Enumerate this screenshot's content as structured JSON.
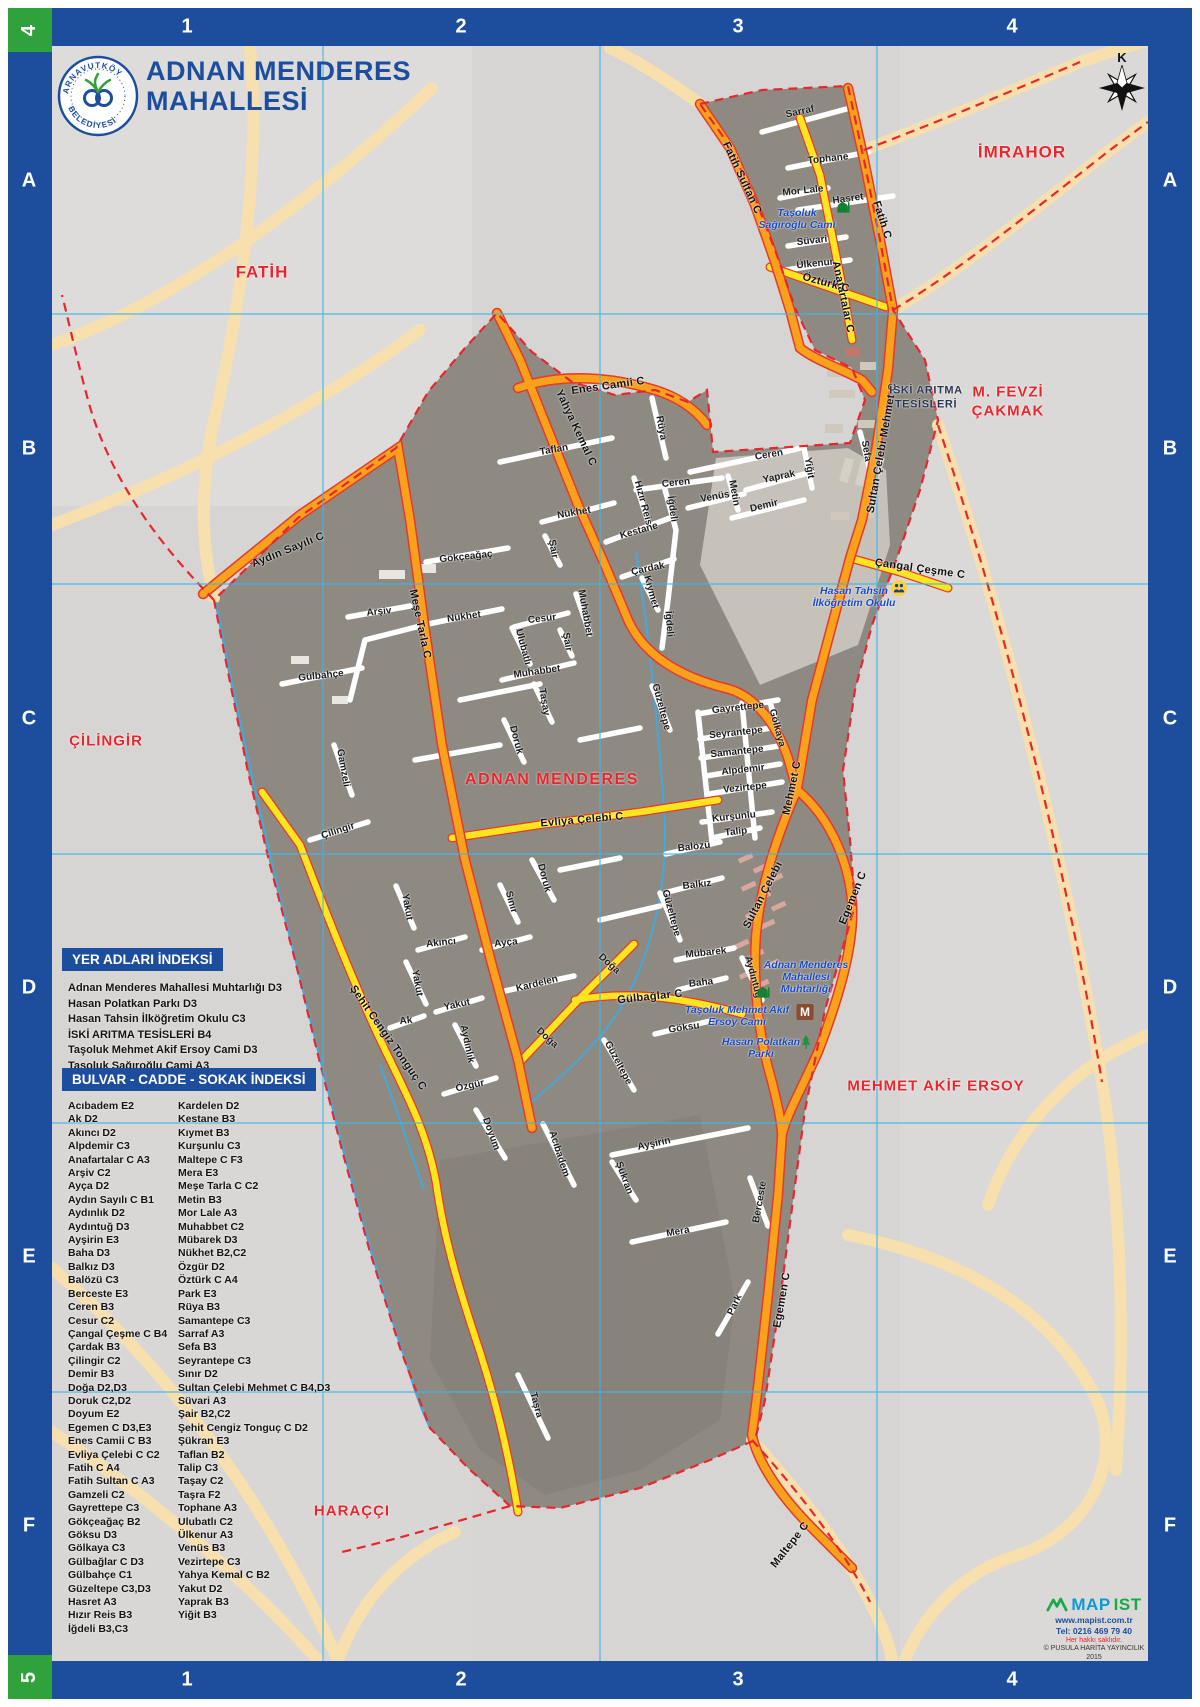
{
  "title": {
    "line1": "ADNAN MENDERES",
    "line2": "MAHALLESİ"
  },
  "logo": {
    "arc_top": "ARNAVUTKÖY",
    "arc_bottom": "BELEDİYESİ"
  },
  "compass": {
    "north": "K"
  },
  "frame": {
    "cols": [
      "1",
      "2",
      "3",
      "4"
    ],
    "rows": [
      "A",
      "B",
      "C",
      "D",
      "E",
      "F"
    ],
    "corner_top": "4",
    "corner_bottom": "5"
  },
  "colors": {
    "frame_blue": "#1d4e9e",
    "corner_green": "#2fa23c",
    "boundary_red": "#e8262d",
    "road_orange": "#f9a11b",
    "road_yellow": "#ffe51f",
    "grid_cyan": "#3cb7e8"
  },
  "map": {
    "area_label": "ADNAN MENDERES",
    "facility_label": {
      "t": "İSKİ ARITMA\nTESİSLERİ",
      "x": 926,
      "y": 398
    },
    "icons": {
      "muhtarlik_letter": "M"
    },
    "neighbor_labels": [
      {
        "t": "FATİH",
        "x": 262,
        "y": 272,
        "s": 17
      },
      {
        "t": "İMRAHOR",
        "x": 1022,
        "y": 152,
        "s": 17
      },
      {
        "t": "M. FEVZİ\nÇAKMAK",
        "x": 1008,
        "y": 402,
        "s": 15
      },
      {
        "t": "ÇİLİNGİR",
        "x": 106,
        "y": 742,
        "s": 15
      },
      {
        "t": "MEHMET AKİF ERSOY",
        "x": 936,
        "y": 1087,
        "s": 15
      },
      {
        "t": "HARAÇÇI",
        "x": 352,
        "y": 1512,
        "s": 15
      }
    ],
    "pois": [
      {
        "t": "Taşoluk\nSağıroğlu Cami",
        "x": 797,
        "y": 219,
        "icon": "mosque",
        "ix": 843,
        "iy": 207
      },
      {
        "t": "Hasan Tahsin\nİlköğretim Okulu",
        "x": 854,
        "y": 597,
        "icon": "school",
        "ix": 899,
        "iy": 588
      },
      {
        "t": "Adnan Menderes\nMahallesi\nMuhtarlığı",
        "x": 806,
        "y": 977,
        "icon": "muhtarlik",
        "ix": 805,
        "iy": 1012
      },
      {
        "t": "Taşoluk Mehmet Akif\nErsoy Cami",
        "x": 737,
        "y": 1016,
        "icon": "mosque",
        "ix": 763,
        "iy": 992
      },
      {
        "t": "Hasan Polatkan\nParkı",
        "x": 761,
        "y": 1048,
        "icon": "park",
        "ix": 806,
        "iy": 1042
      }
    ],
    "street_labels": [
      {
        "t": "Sarraf",
        "x": 800,
        "y": 112,
        "r": -12
      },
      {
        "t": "Fatih Sultan C",
        "x": 742,
        "y": 178,
        "r": 65,
        "c": "rd"
      },
      {
        "t": "Tophane",
        "x": 828,
        "y": 159,
        "r": -6
      },
      {
        "t": "Mor Lale",
        "x": 803,
        "y": 191,
        "r": -6
      },
      {
        "t": "Hasret",
        "x": 848,
        "y": 199,
        "r": -8
      },
      {
        "t": "Süvari",
        "x": 812,
        "y": 241,
        "r": -6
      },
      {
        "t": "Ülkenur",
        "x": 815,
        "y": 264,
        "r": -6
      },
      {
        "t": "Anafartalar C",
        "x": 843,
        "y": 297,
        "r": 78,
        "c": "rd"
      },
      {
        "t": "Öztürk C",
        "x": 826,
        "y": 283,
        "r": 15,
        "c": "rd"
      },
      {
        "t": "Fatih C",
        "x": 882,
        "y": 220,
        "r": 72,
        "c": "rd"
      },
      {
        "t": "Enes Camii C",
        "x": 608,
        "y": 386,
        "r": -8,
        "c": "rd"
      },
      {
        "t": "Yahya Kemal C",
        "x": 576,
        "y": 428,
        "r": 65,
        "c": "rd"
      },
      {
        "t": "Rüya",
        "x": 661,
        "y": 428,
        "r": 80
      },
      {
        "t": "Taflan",
        "x": 554,
        "y": 450,
        "r": -10
      },
      {
        "t": "Ceren",
        "x": 769,
        "y": 455,
        "r": -10
      },
      {
        "t": "Yaprak",
        "x": 779,
        "y": 477,
        "r": -12
      },
      {
        "t": "Yiğit",
        "x": 809,
        "y": 468,
        "r": 80
      },
      {
        "t": "Sefa",
        "x": 866,
        "y": 451,
        "r": 80
      },
      {
        "t": "Ceren",
        "x": 676,
        "y": 483,
        "r": -6
      },
      {
        "t": "Venüs",
        "x": 715,
        "y": 497,
        "r": -10
      },
      {
        "t": "Metin",
        "x": 734,
        "y": 493,
        "r": 80
      },
      {
        "t": "Demir",
        "x": 764,
        "y": 506,
        "r": -14
      },
      {
        "t": "Hızır Reis",
        "x": 643,
        "y": 503,
        "r": 75
      },
      {
        "t": "İğdeli",
        "x": 672,
        "y": 509,
        "r": 82
      },
      {
        "t": "Nükhet",
        "x": 574,
        "y": 513,
        "r": -10
      },
      {
        "t": "Kestane",
        "x": 639,
        "y": 531,
        "r": -16
      },
      {
        "t": "Şair",
        "x": 553,
        "y": 549,
        "r": 80
      },
      {
        "t": "Gökçeağaç",
        "x": 466,
        "y": 557,
        "r": -6
      },
      {
        "t": "Çardak",
        "x": 648,
        "y": 569,
        "r": -12
      },
      {
        "t": "Kıymet",
        "x": 651,
        "y": 592,
        "r": 75
      },
      {
        "t": "Sultan Çelebi Mehmet C",
        "x": 882,
        "y": 448,
        "r": -80,
        "c": "rd"
      },
      {
        "t": "Çangal Çeşme C",
        "x": 920,
        "y": 569,
        "r": 8,
        "c": "rd"
      },
      {
        "t": "Aydın Sayılı C",
        "x": 288,
        "y": 550,
        "r": -22,
        "c": "rd"
      },
      {
        "t": "Meşe Tarla C",
        "x": 420,
        "y": 624,
        "r": 78,
        "c": "rd"
      },
      {
        "t": "Arşiv",
        "x": 379,
        "y": 612,
        "r": -6
      },
      {
        "t": "Nükhet",
        "x": 464,
        "y": 617,
        "r": -8
      },
      {
        "t": "Cesur",
        "x": 542,
        "y": 619,
        "r": -6
      },
      {
        "t": "Muhabbet",
        "x": 585,
        "y": 613,
        "r": 80
      },
      {
        "t": "Şair",
        "x": 567,
        "y": 642,
        "r": 80
      },
      {
        "t": "Ulubatlı",
        "x": 523,
        "y": 647,
        "r": 75
      },
      {
        "t": "Muhabbet",
        "x": 537,
        "y": 672,
        "r": -8
      },
      {
        "t": "Taşay",
        "x": 544,
        "y": 702,
        "r": 80
      },
      {
        "t": "Doruk",
        "x": 516,
        "y": 740,
        "r": 75
      },
      {
        "t": "İğdeli",
        "x": 669,
        "y": 624,
        "r": 85
      },
      {
        "t": "Güzeltepe",
        "x": 661,
        "y": 707,
        "r": 75
      },
      {
        "t": "Gayrettepe",
        "x": 738,
        "y": 708,
        "r": -6
      },
      {
        "t": "Gölkaya",
        "x": 777,
        "y": 728,
        "r": 75
      },
      {
        "t": "Seyrantepe",
        "x": 736,
        "y": 733,
        "r": -6
      },
      {
        "t": "Samantepe",
        "x": 737,
        "y": 752,
        "r": -6
      },
      {
        "t": "Alpdemir",
        "x": 743,
        "y": 770,
        "r": -6
      },
      {
        "t": "Vezirtepe",
        "x": 745,
        "y": 788,
        "r": -6
      },
      {
        "t": "Kurşunlu",
        "x": 734,
        "y": 817,
        "r": -6
      },
      {
        "t": "Talip",
        "x": 736,
        "y": 832,
        "r": -6
      },
      {
        "t": "Gülbahçe",
        "x": 321,
        "y": 676,
        "r": -6
      },
      {
        "t": "Gamzeli",
        "x": 343,
        "y": 768,
        "r": 80
      },
      {
        "t": "Evliya Çelebi C",
        "x": 582,
        "y": 820,
        "r": -5,
        "c": "rd"
      },
      {
        "t": "Çilingir",
        "x": 338,
        "y": 831,
        "r": -18
      },
      {
        "t": "Balözü",
        "x": 694,
        "y": 847,
        "r": -6
      },
      {
        "t": "Balkız",
        "x": 697,
        "y": 885,
        "r": -6
      },
      {
        "t": "Güzeltepe",
        "x": 671,
        "y": 913,
        "r": 75
      },
      {
        "t": "Doruk",
        "x": 544,
        "y": 878,
        "r": 75
      },
      {
        "t": "Sınır",
        "x": 511,
        "y": 902,
        "r": 75
      },
      {
        "t": "Yakut",
        "x": 407,
        "y": 907,
        "r": 80
      },
      {
        "t": "Akıncı",
        "x": 441,
        "y": 943,
        "r": -6
      },
      {
        "t": "Ayça",
        "x": 506,
        "y": 943,
        "r": -6
      },
      {
        "t": "Yakut",
        "x": 417,
        "y": 983,
        "r": 80
      },
      {
        "t": "Yakut",
        "x": 457,
        "y": 1005,
        "r": -12
      },
      {
        "t": "Ak",
        "x": 406,
        "y": 1021,
        "r": -6
      },
      {
        "t": "Doğa",
        "x": 609,
        "y": 964,
        "r": 42
      },
      {
        "t": "Kardelen",
        "x": 537,
        "y": 984,
        "r": -14
      },
      {
        "t": "Gülbağlar C",
        "x": 650,
        "y": 997,
        "r": -6,
        "c": "rd"
      },
      {
        "t": "Mübarek",
        "x": 706,
        "y": 953,
        "r": -6
      },
      {
        "t": "Baha",
        "x": 701,
        "y": 983,
        "r": -6
      },
      {
        "t": "Aydıntuğ",
        "x": 753,
        "y": 977,
        "r": 75
      },
      {
        "t": "Göksu",
        "x": 684,
        "y": 1028,
        "r": -8
      },
      {
        "t": "Mehmet C",
        "x": 792,
        "y": 788,
        "r": -78,
        "c": "rd"
      },
      {
        "t": "Sultan Çelebi",
        "x": 763,
        "y": 895,
        "r": -63,
        "c": "rd"
      },
      {
        "t": "Egemen C",
        "x": 853,
        "y": 898,
        "r": -68,
        "c": "rd"
      },
      {
        "t": "Şehit Cengiz Tonguç C",
        "x": 388,
        "y": 1038,
        "r": 55,
        "c": "rd"
      },
      {
        "t": "Aydınlık",
        "x": 467,
        "y": 1044,
        "r": 78
      },
      {
        "t": "Doğa",
        "x": 547,
        "y": 1038,
        "r": 42
      },
      {
        "t": "Güzeltepe",
        "x": 618,
        "y": 1063,
        "r": 62
      },
      {
        "t": "Özgür",
        "x": 470,
        "y": 1086,
        "r": -12
      },
      {
        "t": "Doyum",
        "x": 491,
        "y": 1134,
        "r": 70
      },
      {
        "t": "Acıbadem",
        "x": 559,
        "y": 1154,
        "r": 72
      },
      {
        "t": "Ayşirin",
        "x": 654,
        "y": 1144,
        "r": -12
      },
      {
        "t": "Şükran",
        "x": 624,
        "y": 1178,
        "r": 70
      },
      {
        "t": "Mera",
        "x": 678,
        "y": 1232,
        "r": -10
      },
      {
        "t": "Berceste",
        "x": 760,
        "y": 1202,
        "r": -80
      },
      {
        "t": "Park",
        "x": 735,
        "y": 1305,
        "r": -65
      },
      {
        "t": "Taşra",
        "x": 536,
        "y": 1405,
        "r": 75
      },
      {
        "t": "Egemen C",
        "x": 782,
        "y": 1300,
        "r": -80,
        "c": "rd"
      },
      {
        "t": "Maltepe C",
        "x": 790,
        "y": 1545,
        "r": -52,
        "c": "rd"
      }
    ]
  },
  "indexes": {
    "yer": {
      "header": "YER ADLARI İNDEKSİ",
      "items": [
        "Adnan Menderes Mahallesi Muhtarlığı D3",
        "Hasan Polatkan Parkı D3",
        "Hasan Tahsin İlköğretim Okulu C3",
        "İSKİ ARITMA TESİSLERİ B4",
        "Taşoluk Mehmet Akif Ersoy Cami D3",
        "Taşoluk Sağıroğlu Cami A3"
      ]
    },
    "sokak": {
      "header": "BULVAR - CADDE - SOKAK İNDEKSİ",
      "col1": [
        "Acıbadem E2",
        "Ak D2",
        "Akıncı D2",
        "Alpdemir C3",
        "Anafartalar C A3",
        "Arşiv C2",
        "Ayça D2",
        "Aydın Sayılı C B1",
        "Aydınlık D2",
        "Aydıntuğ D3",
        "Ayşirin E3",
        "Baha D3",
        "Balkız D3",
        "Balözü C3",
        "Berceste E3",
        "Ceren B3",
        "Cesur C2",
        "Çangal Çeşme C B4",
        "Çardak B3",
        "Çilingir C2",
        "Demir B3",
        "Doğa D2,D3",
        "Doruk C2,D2",
        "Doyum E2",
        "Egemen C D3,E3",
        "Enes Camii C B3",
        "Evliya Çelebi C C2",
        "Fatih C A4",
        "Fatih Sultan C A3",
        "Gamzeli C2",
        "Gayrettepe C3",
        "Gökçeağaç B2",
        "Göksu D3",
        "Gölkaya C3",
        "Gülbağlar C D3",
        "Gülbahçe C1",
        "Güzeltepe C3,D3",
        "Hasret A3",
        "Hızır Reis B3",
        "İğdeli B3,C3"
      ],
      "col2": [
        "Kardelen D2",
        "Kestane B3",
        "Kıymet B3",
        "Kurşunlu C3",
        "Maltepe C F3",
        "Mera E3",
        "Meşe Tarla C C2",
        "Metin B3",
        "Mor Lale A3",
        "Muhabbet C2",
        "Mübarek D3",
        "Nükhet B2,C2",
        "Özgür D2",
        "Öztürk C A4",
        "Park E3",
        "Rüya B3",
        "Samantepe C3",
        "Sarraf A3",
        "Sefa B3",
        "Seyrantepe C3",
        "Sınır D2",
        "Sultan Çelebi Mehmet C B4,D3",
        "Süvari A3",
        "Şair B2,C2",
        "Şehit Cengiz Tonguç C D2",
        "Şükran E3",
        "Taflan B2",
        "Talip C3",
        "Taşay C2",
        "Taşra F2",
        "Tophane A3",
        "Ulubatlı C2",
        "Ülkenur A3",
        "Venüs B3",
        "Vezirtepe C3",
        "Yahya Kemal C B2",
        "Yakut D2",
        "Yaprak B3",
        "Yiğit B3"
      ]
    }
  },
  "credits": {
    "brand_map": "MAP",
    "brand_ist": "IST",
    "url": "www.mapist.com.tr",
    "tel": "Tel: 0216 469 79 40",
    "rights": "Her hakkı saklıdır.",
    "copyright": "© PUSULA HARİTA YAYINCILIK 2015"
  }
}
